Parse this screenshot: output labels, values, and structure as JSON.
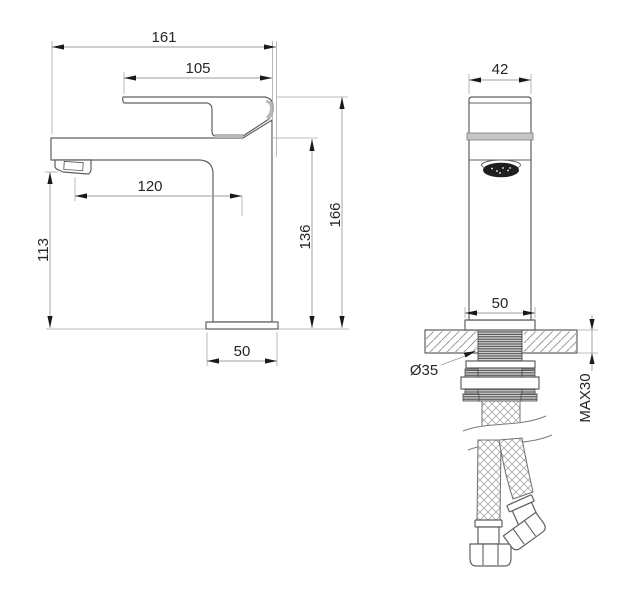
{
  "drawing": {
    "type": "technical-dimension-drawing",
    "subject": "single-lever basin mixer faucet with mounting hardware and flexible supply hoses",
    "views": {
      "side": {
        "name": "side view",
        "dimensions": {
          "overall_length": "161",
          "handle_length": "105",
          "spout_reach": "120",
          "spout_height": "113",
          "body_height": "136",
          "overall_height": "166",
          "base_width": "50"
        }
      },
      "front": {
        "name": "front view",
        "dimensions": {
          "body_width": "42",
          "base_width": "50",
          "mounting_hole_diameter": "Ø35",
          "max_deck_thickness": "MAX30"
        }
      }
    },
    "colors": {
      "background": "#ffffff",
      "outline": "#606060",
      "dimension_line": "#9c9c9c",
      "arrow": "#1a1a1a",
      "text": "#262626",
      "accent_gray": "#b8b8b8",
      "aerator_dark": "#1e1e1e"
    }
  }
}
